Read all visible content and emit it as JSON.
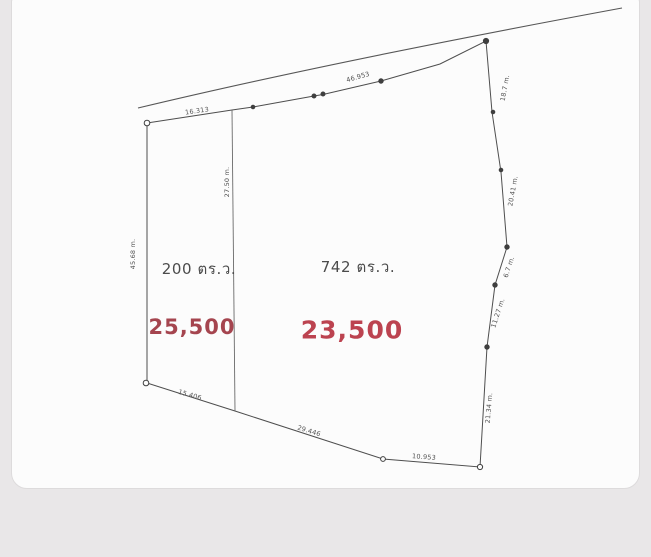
{
  "page": {
    "background_color": "#e9e7e8",
    "paper_color": "#fcfcfc"
  },
  "diagram": {
    "line_color": "#4e4e4e",
    "plots": [
      {
        "id": "left",
        "area": "200 ตร.ว.",
        "price": "25,500",
        "price_color": "#a5454f"
      },
      {
        "id": "right",
        "area": "742 ตร.ว.",
        "price": "23,500",
        "price_color": "#bc4350"
      }
    ],
    "dimensions": [
      {
        "text": "16.313",
        "x": 197,
        "y": 111,
        "rot": -8
      },
      {
        "text": "46.953",
        "x": 358,
        "y": 77,
        "rot": -16
      },
      {
        "text": "18.7 m.",
        "x": 505,
        "y": 88,
        "rot": -80
      },
      {
        "text": "20.41 m.",
        "x": 513,
        "y": 191,
        "rot": -80
      },
      {
        "text": "6.7 m.",
        "x": 509,
        "y": 267,
        "rot": -72
      },
      {
        "text": "11.27 m.",
        "x": 498,
        "y": 313,
        "rot": -72
      },
      {
        "text": "21.34 m.",
        "x": 489,
        "y": 408,
        "rot": -85
      },
      {
        "text": "45.68 m.",
        "x": 133,
        "y": 254,
        "rot": -90
      },
      {
        "text": "27.50 m.",
        "x": 227,
        "y": 182,
        "rot": -90
      },
      {
        "text": "15.406",
        "x": 190,
        "y": 395,
        "rot": 16
      },
      {
        "text": "29.446",
        "x": 309,
        "y": 431,
        "rot": 17
      },
      {
        "text": "10.953",
        "x": 424,
        "y": 457,
        "rot": 4
      }
    ]
  }
}
